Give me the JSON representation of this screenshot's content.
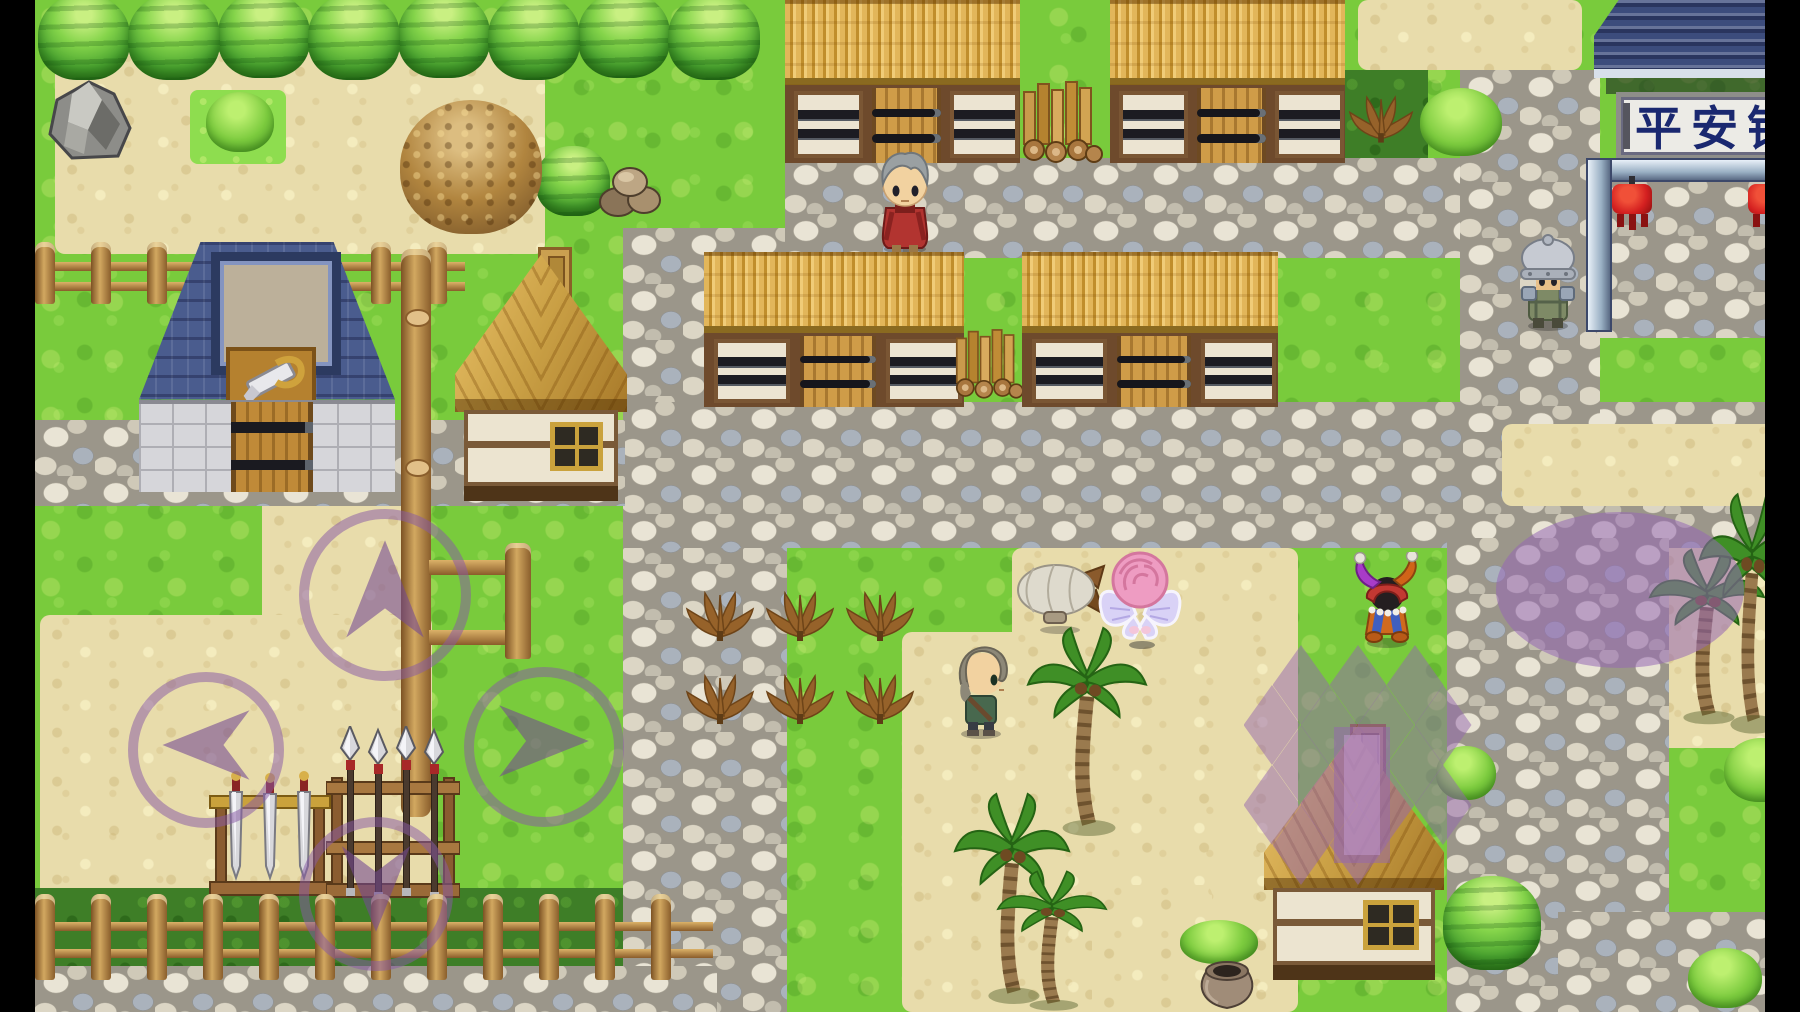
{
  "meta": {
    "app": "RPG game screenshot (RPG Maker-style top-down village scene)",
    "scene_name_on_sign": "平安镇",
    "letterbox": "black bars left and right"
  },
  "hud": {
    "sign": {
      "text": "平安镇",
      "text_color": "#1a2870",
      "bg": "#ecebe6"
    },
    "dpad": {
      "purple": "rgba(136,90,165,0.52)",
      "buttons": [
        {
          "dir": "up",
          "cx": 385,
          "cy": 595,
          "r": 86
        },
        {
          "dir": "left",
          "cx": 206,
          "cy": 750,
          "r": 78
        },
        {
          "dir": "right",
          "cx": 544,
          "cy": 747,
          "r": 80
        },
        {
          "dir": "down",
          "cx": 376,
          "cy": 894,
          "r": 77
        }
      ]
    },
    "speech_bubble": {
      "cx": 1620,
      "cy": 590,
      "rx": 124,
      "ry": 78,
      "tail_tip_x": 1548,
      "tail_tip_y": 712,
      "fill": "rgba(150,104,180,0.55)"
    },
    "path_diamonds": {
      "size_w": 57,
      "size_h": 80,
      "fill": "rgba(148,102,176,0.5)",
      "centers": [
        [
          1301,
          685
        ],
        [
          1358,
          685
        ],
        [
          1415,
          685
        ],
        [
          1272,
          725
        ],
        [
          1329,
          725
        ],
        [
          1386,
          725
        ],
        [
          1443,
          725
        ],
        [
          1301,
          765
        ],
        [
          1358,
          765
        ],
        [
          1415,
          765
        ],
        [
          1272,
          805
        ],
        [
          1329,
          805
        ],
        [
          1386,
          805
        ],
        [
          1443,
          805
        ],
        [
          1301,
          845
        ],
        [
          1358,
          845
        ]
      ],
      "chimney_highlight": {
        "x": 1334,
        "y": 727,
        "w": 56,
        "h": 136
      }
    }
  },
  "palette": {
    "grass": "#79cb3c",
    "sand": "#e8dcab",
    "stone_path": "#c8c3b4",
    "dark_grass": "#3e7e27",
    "thatch": "#d9a94f",
    "blue_roof": "#4a5c8e",
    "wood": "#b5842e",
    "lantern_red": "#d42020"
  },
  "scene": {
    "width": 1800,
    "height": 1012,
    "map_left": 35,
    "map_right": 1765,
    "ground": [
      {
        "n": "sand-top-left",
        "t": "sand",
        "x": 55,
        "y": 52,
        "w": 490,
        "h": 202
      },
      {
        "n": "sand-top-right",
        "t": "sand",
        "x": 1358,
        "y": 0,
        "w": 224,
        "h": 70
      },
      {
        "n": "sand-dpad-vertical",
        "t": "sand",
        "x": 262,
        "y": 452,
        "w": 168,
        "h": 478
      },
      {
        "n": "sand-dpad-left",
        "t": "sand",
        "x": 40,
        "y": 615,
        "w": 392,
        "h": 310
      },
      {
        "n": "sand-center-top",
        "t": "sand",
        "x": 1012,
        "y": 548,
        "w": 286,
        "h": 126
      },
      {
        "n": "sand-center",
        "t": "sand",
        "x": 902,
        "y": 632,
        "w": 396,
        "h": 380
      },
      {
        "n": "sand-pot-patch",
        "t": "sand",
        "x": 1092,
        "y": 885,
        "w": 120,
        "h": 127
      },
      {
        "n": "sand-right-palm",
        "t": "sand",
        "x": 1652,
        "y": 492,
        "w": 148,
        "h": 256
      },
      {
        "n": "dark-grass-top-right",
        "t": "dark",
        "x": 1338,
        "y": 70,
        "w": 90,
        "h": 94
      },
      {
        "n": "dark-grass-fence-row",
        "t": "dark",
        "x": 35,
        "y": 888,
        "w": 682,
        "h": 88
      },
      {
        "n": "stone-path-main",
        "t": "stone",
        "x": 623,
        "y": 228,
        "w": 164,
        "h": 784
      },
      {
        "n": "stone-top-band",
        "t": "stone",
        "x": 785,
        "y": 158,
        "w": 780,
        "h": 100
      },
      {
        "n": "stone-mid-band",
        "t": "stone",
        "x": 623,
        "y": 402,
        "w": 1177,
        "h": 146
      },
      {
        "n": "stone-right-column",
        "t": "stone",
        "x": 1460,
        "y": 70,
        "w": 140,
        "h": 362
      },
      {
        "n": "stone-gate-court",
        "t": "stone",
        "x": 1596,
        "y": 180,
        "w": 204,
        "h": 158
      },
      {
        "n": "stone-bottom-right",
        "t": "stone",
        "x": 1447,
        "y": 538,
        "w": 222,
        "h": 474
      },
      {
        "n": "stone-br-corner",
        "t": "stone",
        "x": 1558,
        "y": 912,
        "w": 242,
        "h": 100
      },
      {
        "n": "stone-bottom-left",
        "t": "stone",
        "x": 35,
        "y": 966,
        "w": 682,
        "h": 46
      },
      {
        "n": "stone-left-band",
        "t": "stone",
        "x": 35,
        "y": 420,
        "w": 590,
        "h": 86
      },
      {
        "n": "sand-right-band",
        "t": "sand2",
        "x": 1502,
        "y": 424,
        "w": 298,
        "h": 82
      },
      {
        "n": "grass-island",
        "t": "grassy",
        "x": 190,
        "y": 90,
        "w": 96,
        "h": 74
      }
    ],
    "objects": [
      {
        "n": "tree-row-1",
        "t": "tree",
        "x": 38,
        "y": -6,
        "w": 92,
        "h": 86
      },
      {
        "n": "tree-row-2",
        "t": "tree",
        "x": 128,
        "y": -6,
        "w": 92,
        "h": 86
      },
      {
        "n": "tree-row-3",
        "t": "tree",
        "x": 218,
        "y": -8,
        "w": 92,
        "h": 86
      },
      {
        "n": "tree-row-4",
        "t": "tree",
        "x": 308,
        "y": -6,
        "w": 92,
        "h": 86
      },
      {
        "n": "tree-row-5",
        "t": "tree",
        "x": 398,
        "y": -8,
        "w": 92,
        "h": 86
      },
      {
        "n": "tree-row-6",
        "t": "tree",
        "x": 488,
        "y": -6,
        "w": 92,
        "h": 86
      },
      {
        "n": "tree-row-7",
        "t": "tree",
        "x": 578,
        "y": -8,
        "w": 92,
        "h": 86
      },
      {
        "n": "tree-row-8",
        "t": "tree",
        "x": 668,
        "y": -6,
        "w": 92,
        "h": 86
      },
      {
        "n": "rock-boulder",
        "t": "rock",
        "x": 44,
        "y": 78,
        "w": 90,
        "h": 84
      },
      {
        "n": "bush-top-left",
        "t": "bush",
        "x": 206,
        "y": 92,
        "w": 68,
        "h": 60
      },
      {
        "n": "leaf-mound",
        "t": "leafpile",
        "x": 400,
        "y": 100,
        "w": 142,
        "h": 134
      },
      {
        "n": "tree-single",
        "t": "tree",
        "x": 536,
        "y": 146,
        "w": 74,
        "h": 70
      },
      {
        "n": "rock-pile",
        "t": "rockpile",
        "x": 596,
        "y": 154,
        "w": 68,
        "h": 66
      },
      {
        "n": "longhouse-top-left",
        "t": "thatch",
        "x": 785,
        "y": 0,
        "w": 235,
        "h": 163
      },
      {
        "n": "woodpile-top",
        "t": "woodpile",
        "x": 1016,
        "y": 78,
        "w": 92,
        "h": 86
      },
      {
        "n": "longhouse-top-right",
        "t": "thatch",
        "x": 1110,
        "y": 0,
        "w": 235,
        "h": 163
      },
      {
        "n": "dry-fern-top-right",
        "t": "fern",
        "x": 1348,
        "y": 88,
        "w": 66,
        "h": 62
      },
      {
        "n": "bush-top-right",
        "t": "bush",
        "x": 1420,
        "y": 88,
        "w": 82,
        "h": 68
      },
      {
        "n": "town-gate",
        "t": "gate",
        "x": 1578,
        "y": 0,
        "w": 222,
        "h": 338
      },
      {
        "n": "fence-shop-row",
        "t": "fence",
        "x": 35,
        "y": 242,
        "w": 430,
        "h": 62
      },
      {
        "n": "weapon-shop",
        "t": "shop",
        "x": 139,
        "y": 242,
        "w": 256,
        "h": 250
      },
      {
        "n": "wood-house-left",
        "t": "house",
        "x": 455,
        "y": 247,
        "w": 172,
        "h": 254
      },
      {
        "n": "pole-fence",
        "t": "polefence",
        "x": 401,
        "y": 249,
        "w": 150,
        "h": 568
      },
      {
        "n": "longhouse-mid-left",
        "t": "thatch",
        "x": 704,
        "y": 252,
        "w": 260,
        "h": 155
      },
      {
        "n": "woodpile-mid",
        "t": "woodpile",
        "x": 950,
        "y": 318,
        "w": 78,
        "h": 90
      },
      {
        "n": "longhouse-mid-right",
        "t": "thatch",
        "x": 1022,
        "y": 252,
        "w": 256,
        "h": 155
      },
      {
        "n": "crop-fern-1",
        "t": "fern",
        "x": 685,
        "y": 585,
        "w": 70,
        "h": 62
      },
      {
        "n": "crop-fern-2",
        "t": "fern",
        "x": 765,
        "y": 585,
        "w": 70,
        "h": 62
      },
      {
        "n": "crop-fern-3",
        "t": "fern",
        "x": 845,
        "y": 585,
        "w": 70,
        "h": 62
      },
      {
        "n": "crop-fern-4",
        "t": "fern",
        "x": 685,
        "y": 668,
        "w": 70,
        "h": 62
      },
      {
        "n": "crop-fern-5",
        "t": "fern",
        "x": 765,
        "y": 668,
        "w": 70,
        "h": 62
      },
      {
        "n": "crop-fern-6",
        "t": "fern",
        "x": 845,
        "y": 668,
        "w": 70,
        "h": 62
      },
      {
        "n": "airship-blimp",
        "t": "blimp",
        "x": 1016,
        "y": 562,
        "w": 92,
        "h": 72
      },
      {
        "n": "fairy-npc",
        "t": "fairy",
        "x": 1096,
        "y": 546,
        "w": 88,
        "h": 104
      },
      {
        "n": "jester-npc",
        "t": "jester",
        "x": 1352,
        "y": 552,
        "w": 70,
        "h": 96
      },
      {
        "n": "old-man-npc",
        "t": "oldman",
        "x": 872,
        "y": 148,
        "w": 66,
        "h": 108
      },
      {
        "n": "soldier-npc",
        "t": "soldier",
        "x": 1516,
        "y": 232,
        "w": 64,
        "h": 100
      },
      {
        "n": "player-character",
        "t": "player",
        "x": 949,
        "y": 640,
        "w": 64,
        "h": 100
      },
      {
        "n": "palm-tree-1",
        "t": "palm",
        "x": 1026,
        "y": 626,
        "w": 122,
        "h": 212
      },
      {
        "n": "palm-tree-2",
        "t": "palm",
        "x": 953,
        "y": 792,
        "w": 118,
        "h": 214
      },
      {
        "n": "palm-tree-3",
        "t": "palm",
        "x": 996,
        "y": 870,
        "w": 112,
        "h": 142
      },
      {
        "n": "palm-tree-right-1",
        "t": "palm",
        "x": 1648,
        "y": 548,
        "w": 118,
        "h": 178
      },
      {
        "n": "palm-tree-right-2",
        "t": "palm",
        "x": 1698,
        "y": 492,
        "w": 108,
        "h": 244
      },
      {
        "n": "sword-rack",
        "t": "swordrack",
        "x": 208,
        "y": 770,
        "w": 124,
        "h": 134
      },
      {
        "n": "spear-rack",
        "t": "spearrack",
        "x": 326,
        "y": 726,
        "w": 134,
        "h": 180
      },
      {
        "n": "fence-bottom-row",
        "t": "fence",
        "x": 35,
        "y": 894,
        "w": 678,
        "h": 86
      },
      {
        "n": "wood-house-bottom",
        "t": "house",
        "x": 1264,
        "y": 724,
        "w": 180,
        "h": 256
      },
      {
        "n": "tree-bottom-right",
        "t": "tree",
        "x": 1443,
        "y": 876,
        "w": 98,
        "h": 94
      },
      {
        "n": "bush-mid-right",
        "t": "bush",
        "x": 1436,
        "y": 746,
        "w": 60,
        "h": 54
      },
      {
        "n": "bush-far-right-1",
        "t": "bush",
        "x": 1724,
        "y": 738,
        "w": 74,
        "h": 64
      },
      {
        "n": "bush-far-right-2",
        "t": "bush",
        "x": 1688,
        "y": 948,
        "w": 74,
        "h": 60
      },
      {
        "n": "bush-near-pot",
        "t": "bush",
        "x": 1180,
        "y": 920,
        "w": 78,
        "h": 44
      },
      {
        "n": "clay-pot",
        "t": "pot",
        "x": 1194,
        "y": 958,
        "w": 66,
        "h": 54
      }
    ]
  }
}
